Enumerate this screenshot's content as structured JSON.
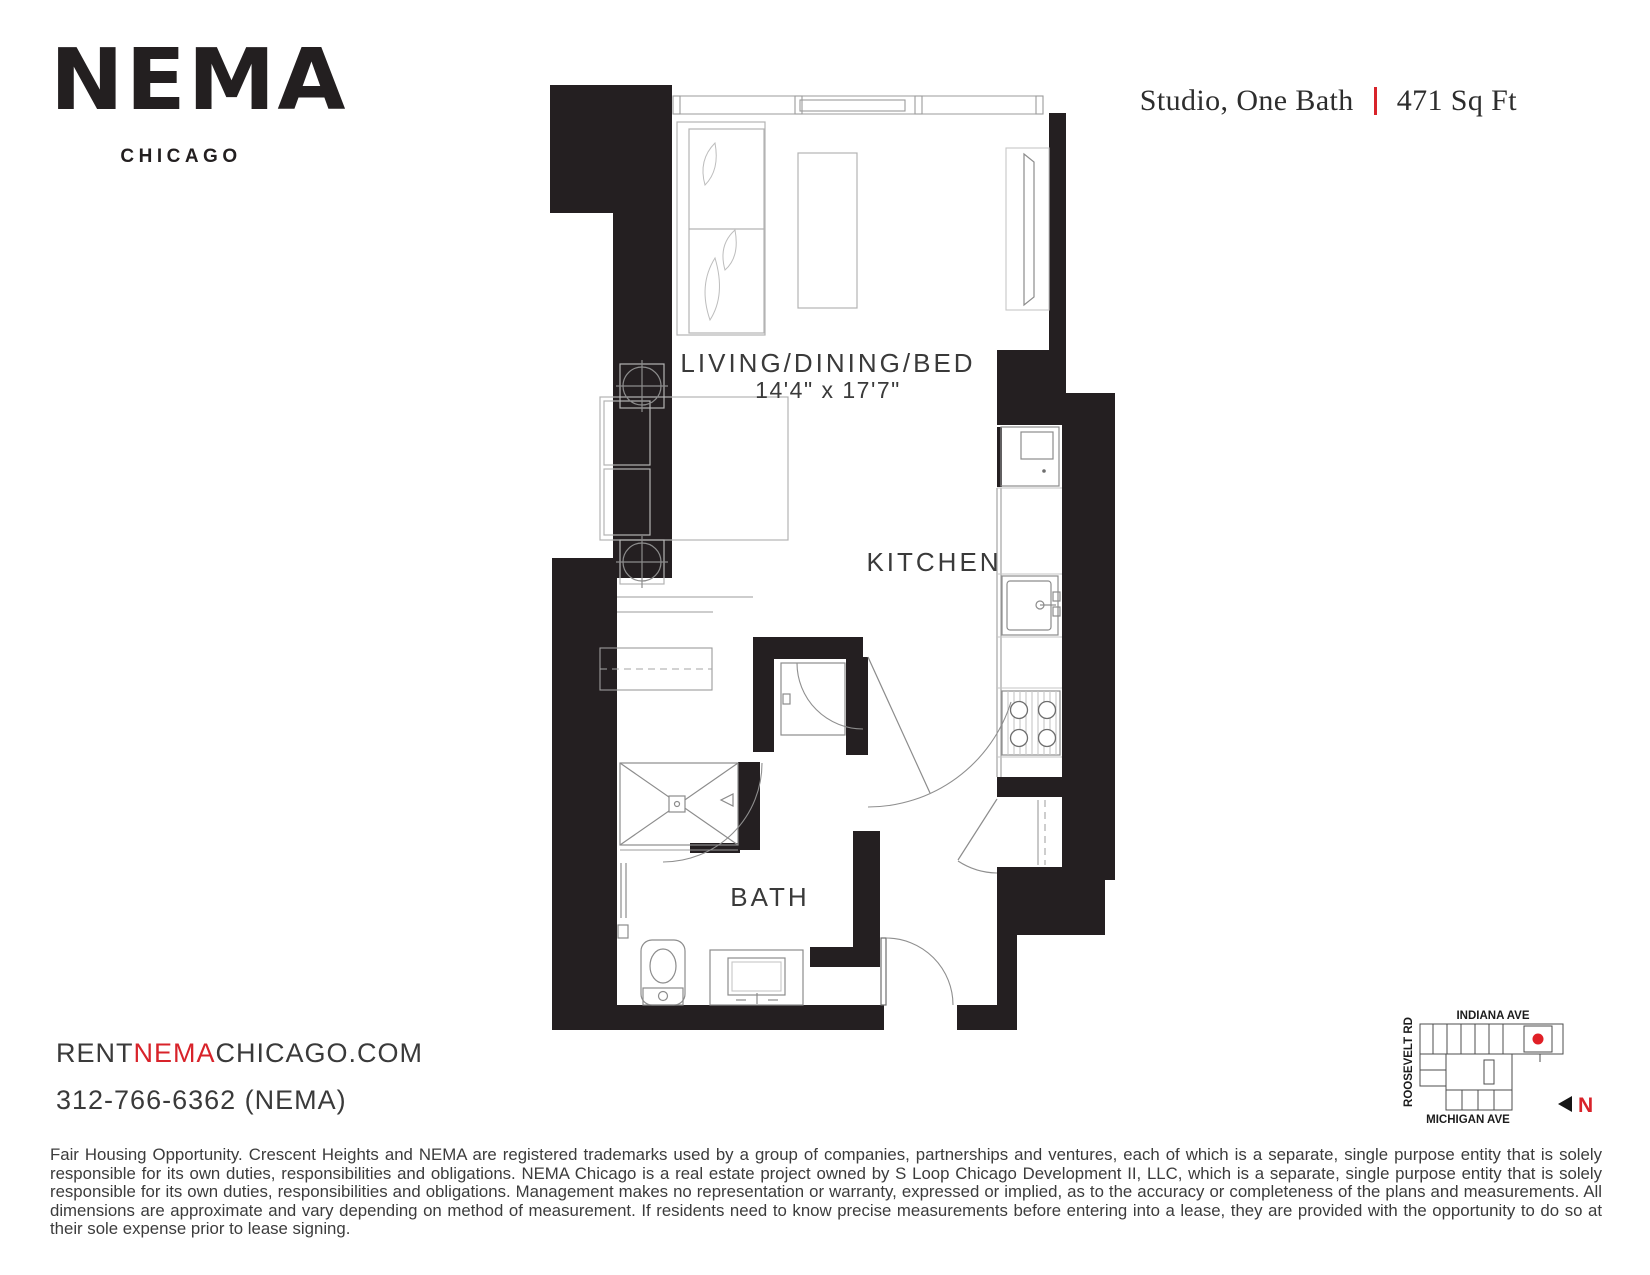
{
  "brand": {
    "logo": "NEMA",
    "city": "CHICAGO"
  },
  "unit": {
    "type": "Studio, One Bath",
    "area": "471 Sq Ft"
  },
  "plan": {
    "living_label": "LIVING/DINING/BED",
    "living_dims": "14'4\" x 17'7\"",
    "kitchen_label": "KITCHEN",
    "bath_label": "BATH"
  },
  "contact": {
    "url_rent": "RENT",
    "url_nema": "NEMA",
    "url_rest": "CHICAGO.COM",
    "phone": "312-766-6362 (NEMA)"
  },
  "map": {
    "street_top": "INDIANA AVE",
    "street_left": "ROOSEVELT RD",
    "street_bottom": "MICHIGAN AVE",
    "north_label": "N"
  },
  "disclaimer": "Fair Housing Opportunity. Crescent Heights and NEMA are registered trademarks used by a group of companies, partnerships and ventures, each of which is a separate, single purpose entity that is solely responsible for its own duties, responsibilities and obligations. NEMA Chicago is a real estate project owned by S Loop Chicago Development II, LLC, which is a separate, single purpose entity that is solely responsible for its own duties, responsibilities and obligations. Management makes no representation or warranty, expressed or implied, as to the accuracy or completeness of the plans and measurements. All dimensions are approximate and vary depending on method of measurement. If residents need to know precise measurements before entering into a lease, they are provided with the opportunity to do so at their sole expense prior to lease signing.",
  "colors": {
    "accent_red": "#d8232a",
    "wall": "#241f21",
    "text_dark": "#3a3a3a"
  }
}
